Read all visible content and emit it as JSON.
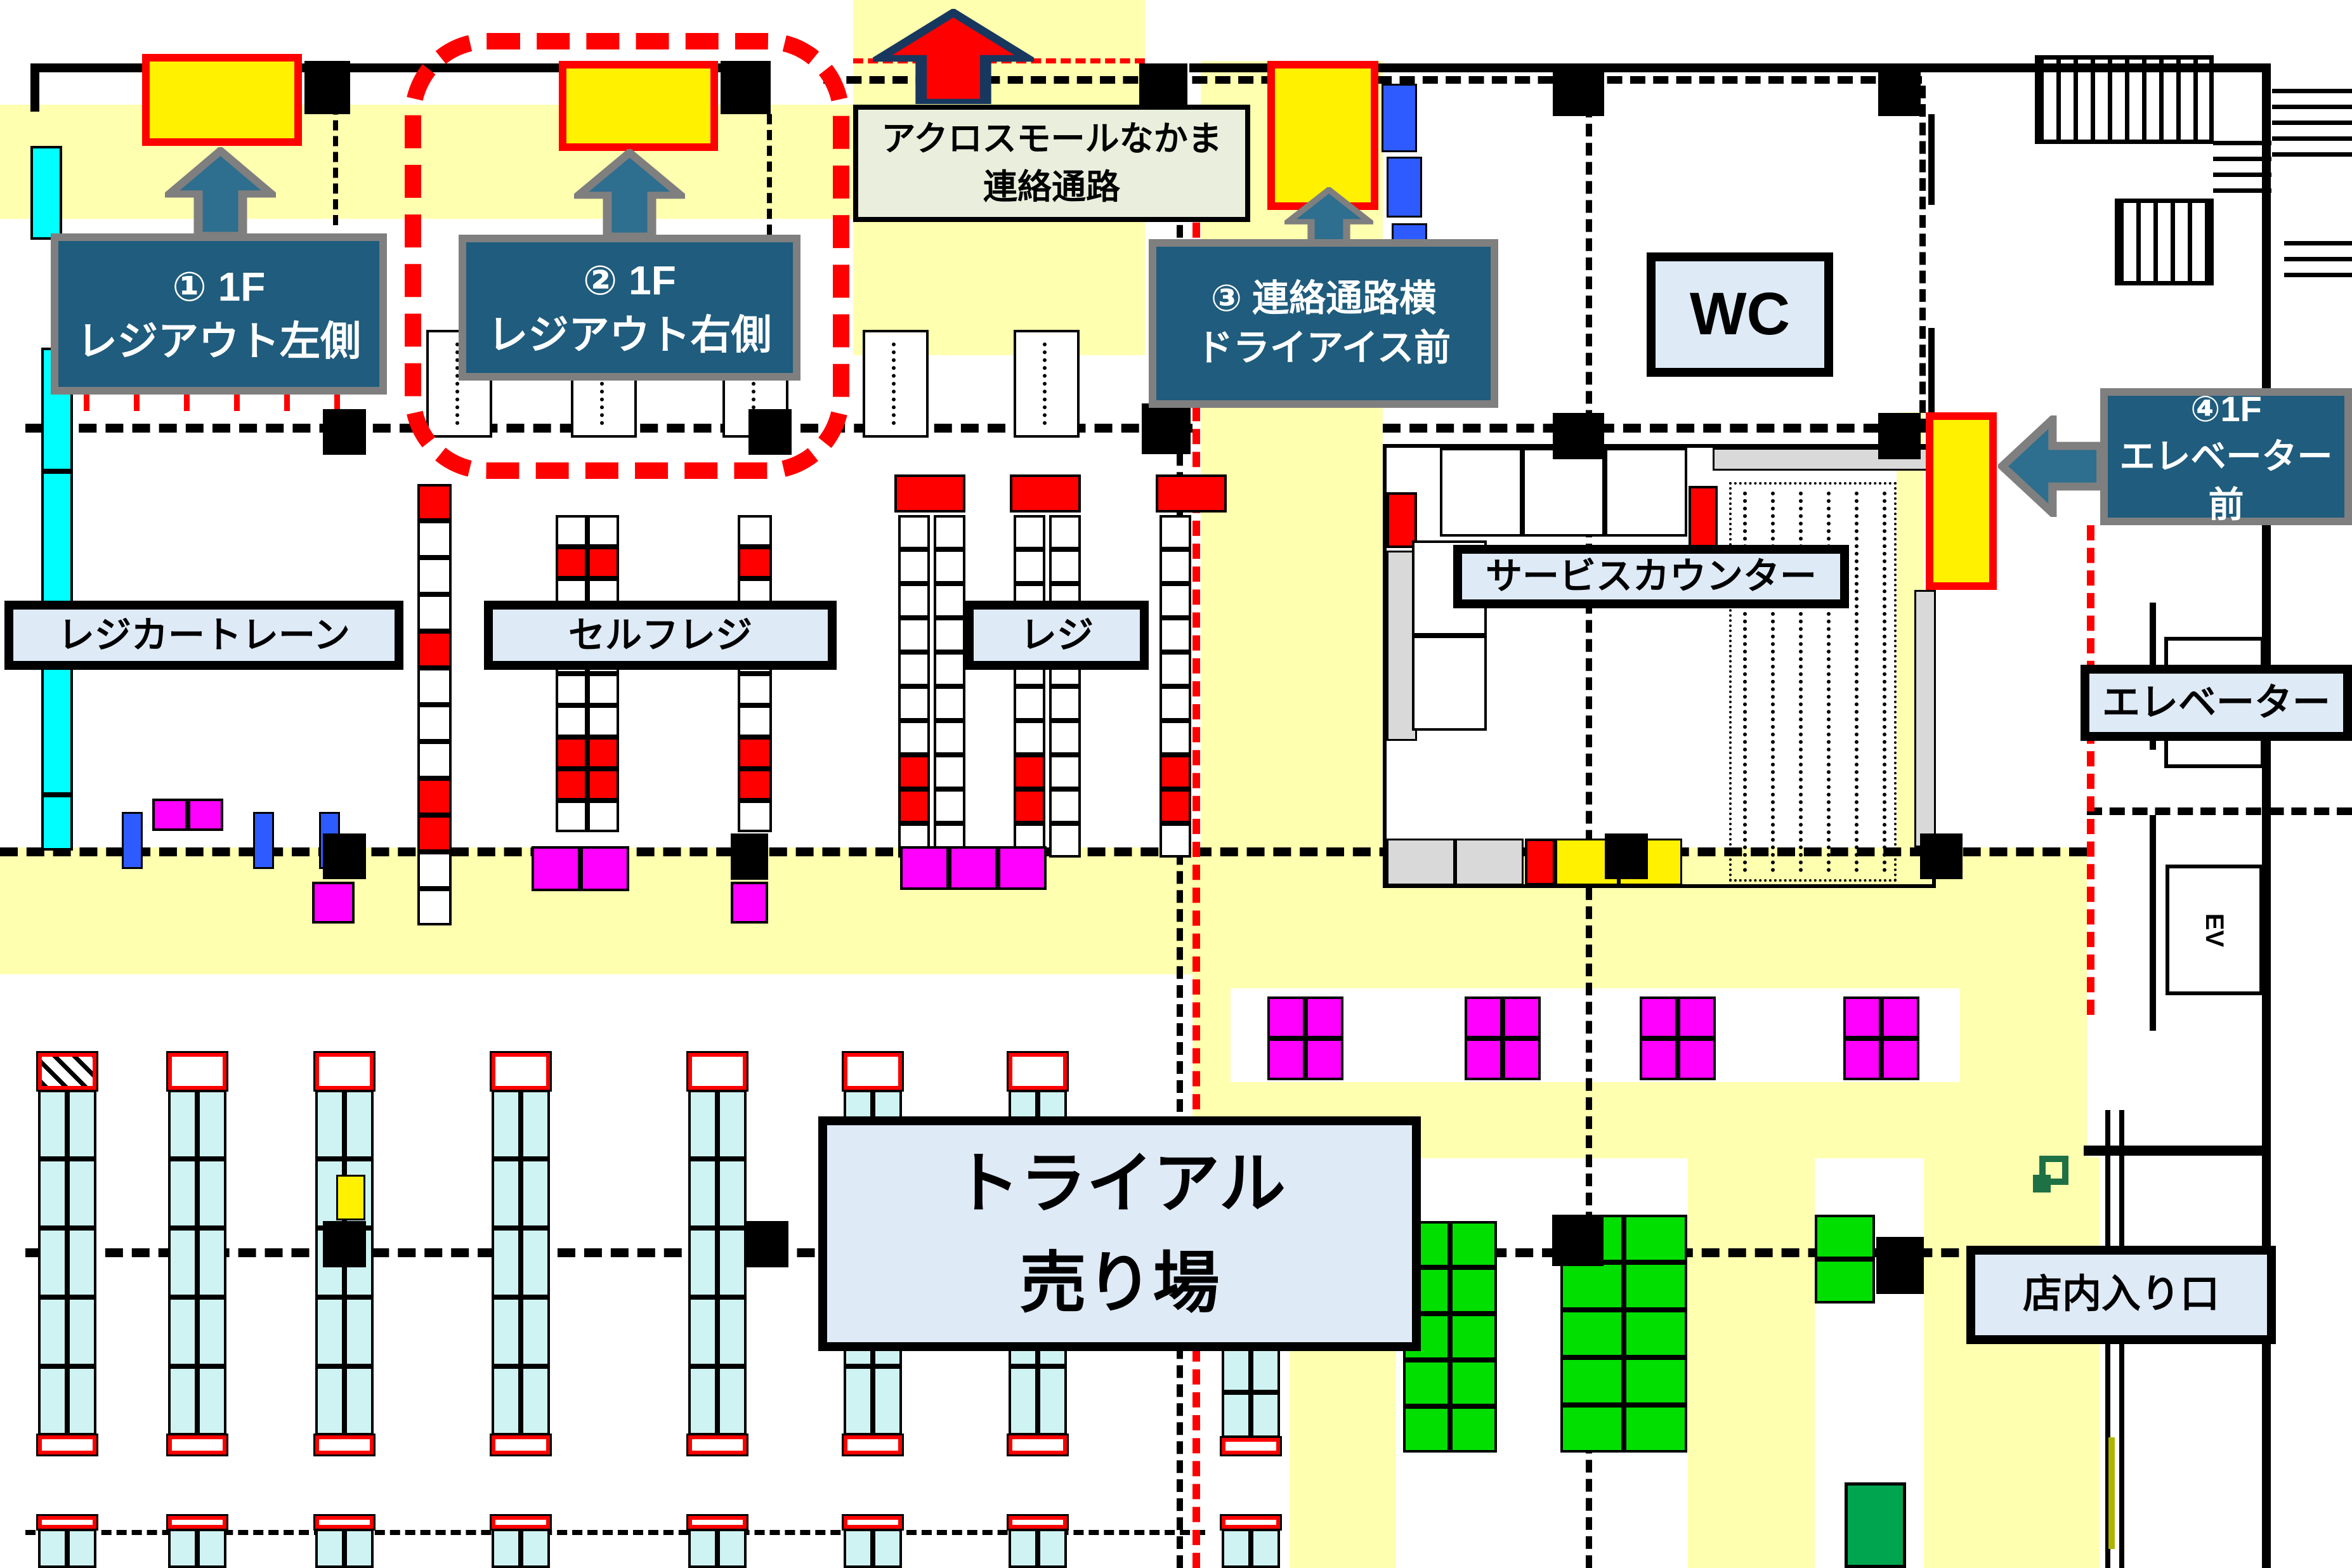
{
  "labels": {
    "loc1_line1": "① 1F",
    "loc1_line2": "レジアウト左側",
    "loc2_line1": "② 1F",
    "loc2_line2": "レジアウト右側",
    "loc3_line1": "③ 連絡通路横",
    "loc3_line2": "ドライアイス前",
    "loc4_line1": "④1F",
    "loc4_line2": "エレベーター前",
    "passage_line1": "アクロスモールなかま",
    "passage_line2": "連絡通路",
    "wc": "WC",
    "service_counter": "サービスカウンター",
    "cart_lane": "レジカートレーン",
    "self_checkout": "セルフレジ",
    "checkout": "レジ",
    "elevator": "エレベーター",
    "ev": "EV",
    "sales_floor_line1": "トライアル",
    "sales_floor_line2": "売り場",
    "entrance": "店内入り口"
  },
  "colors": {
    "highlight_box": "#FFF100",
    "highlight_border": "#FF0000",
    "callout_bg": "#1F5C7D",
    "callout_border": "#7F7F7F",
    "label_bg": "#DEEAF6",
    "passage_bg": "#E9EFDC",
    "aisle_yellow": "#FFFFB0",
    "shelf_cyan": "#CFF3F3",
    "cart_strip_cyan": "#00FFFF",
    "magenta": "#FF00FF",
    "shelf_green": "#00DF00",
    "dark_green": "#00A550",
    "icon_green": "#1E7145",
    "blue": "#2E5BFF",
    "red": "#FF0000"
  }
}
